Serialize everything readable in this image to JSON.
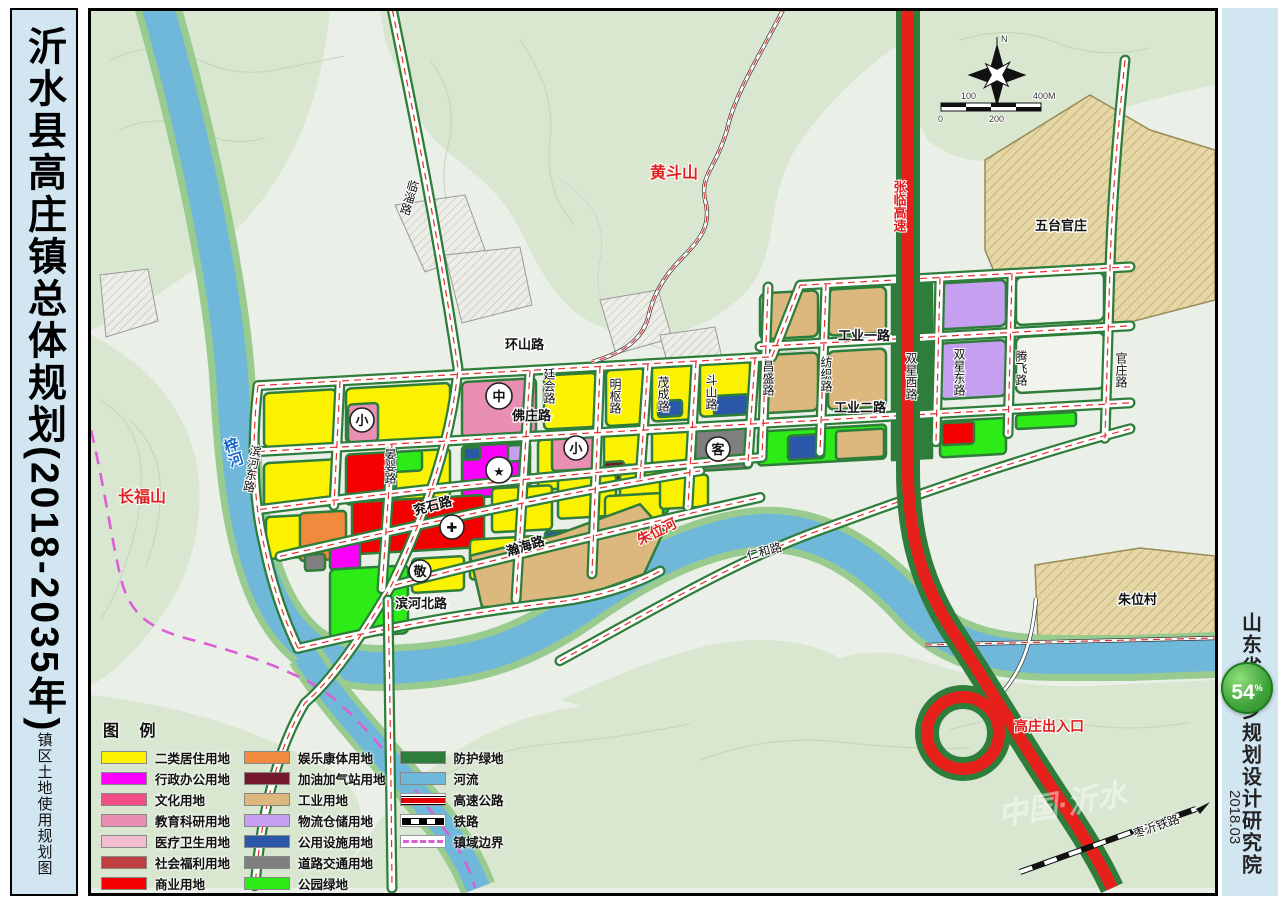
{
  "left_panel": {
    "title": "沂水县高庄镇总体规划(2018-2035年)",
    "page_number": "17",
    "subtitle": "镇区土地使用规划图"
  },
  "right_panel": {
    "institute": "山东省城乡规划设计研究院",
    "date": "2018.03",
    "badge": {
      "value": "54",
      "suffix": "%"
    }
  },
  "map": {
    "place_labels": {
      "huangdoushan": "黄斗山",
      "changfushan": "长福山",
      "zihe": "梓河",
      "zhuweihe": "朱位河",
      "wutai_guanzhuang": "五台官庄",
      "zhuwei_village": "朱位村",
      "zhanglin_expressway": "张临高速",
      "gaozhuang_exit": "高庄出入口",
      "railway": "枣沂铁路",
      "watermark": "中国·沂水",
      "north": "N"
    },
    "road_labels": {
      "linzi": "临淄路",
      "huanshan": "环山路",
      "fozhuang": "佛庄路",
      "tinghui": "廷会路",
      "mingshu": "明枢路",
      "maocheng": "茂成路",
      "doushan": "斗山路",
      "changsheng": "昌盛路",
      "fangzhi": "纺织路",
      "gongye_yi": "工业一路",
      "gongye_er": "工业二路",
      "shuangxing_xi": "双星西路",
      "shuangxing_dong": "双星东路",
      "tengfei": "腾飞路",
      "guanzhuang": "官庄路",
      "yanying": "晏婴路",
      "yanshi": "兖石路",
      "hanhai": "瀚海路",
      "binhe_bei": "滨河北路",
      "binhe_dong": "滨河东路",
      "renhe": "仁和路"
    },
    "markers": {
      "xiao": "小",
      "zhong": "中",
      "ke": "客",
      "jing": "敬",
      "star": "★",
      "cross": "✚"
    },
    "scale_bar": {
      "n0": "0",
      "n100": "100",
      "n200": "200",
      "n400": "400M"
    }
  },
  "legend": {
    "title": "图 例",
    "col1": [
      {
        "label": "二类居住用地",
        "color": "#FBF202"
      },
      {
        "label": "行政办公用地",
        "color": "#FB00FB"
      },
      {
        "label": "文化用地",
        "color": "#EE4D86"
      },
      {
        "label": "教育科研用地",
        "color": "#E98FB4"
      },
      {
        "label": "医疗卫生用地",
        "color": "#F2BDCF"
      },
      {
        "label": "社会福利用地",
        "color": "#BE4040"
      },
      {
        "label": "商业用地",
        "color": "#F40000"
      }
    ],
    "col2": [
      {
        "label": "娱乐康体用地",
        "color": "#F08A3C"
      },
      {
        "label": "加油加气站用地",
        "color": "#75182E"
      },
      {
        "label": "工业用地",
        "color": "#DDB87E"
      },
      {
        "label": "物流仓储用地",
        "color": "#C5A0F0"
      },
      {
        "label": "公用设施用地",
        "color": "#2B57A8"
      },
      {
        "label": "道路交通用地",
        "color": "#7F7F7F"
      },
      {
        "label": "公园绿地",
        "color": "#2CEB16"
      }
    ],
    "col3": [
      {
        "label": "防护绿地",
        "color": "#2E7D3A"
      },
      {
        "label": "河流",
        "color": "#6FB8DA"
      },
      {
        "label": "高速公路"
      },
      {
        "label": "铁路"
      },
      {
        "label": "镇域边界"
      }
    ]
  }
}
